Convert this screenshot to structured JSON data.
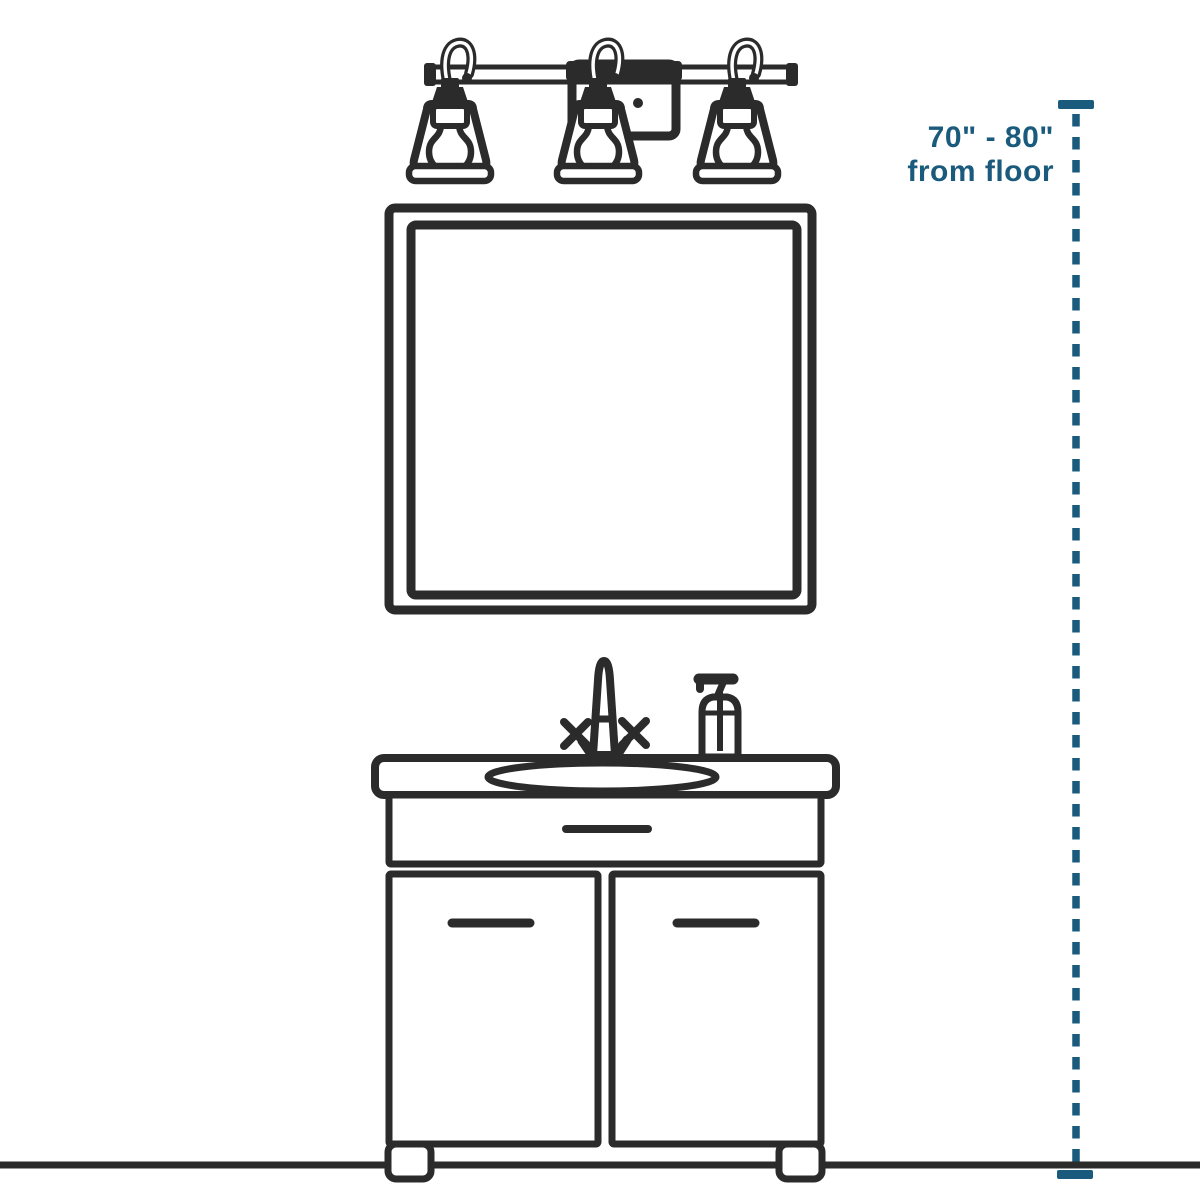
{
  "page": {
    "kind": "installation-height-diagram",
    "background": "#ffffff"
  },
  "annotation": {
    "line1": "70\" - 80\"",
    "line2": "from floor"
  },
  "colors": {
    "ink": "#2b2b2b",
    "accent": "#1a5b7d",
    "paper": "#ffffff"
  },
  "figure": {
    "style": "black-outline line drawing on white",
    "light_count": 3,
    "parts": [
      "three-light-vanity-bar-light",
      "square-wall-mirror",
      "bathroom-vanity-cabinet",
      "oval-sink-basin",
      "two-handle-faucet",
      "soap-dispenser",
      "drawer-front",
      "two-cabinet-doors",
      "cabinet-feet",
      "floor-line",
      "dashed-height-measurement-line"
    ],
    "measurement": {
      "from": "floor",
      "min": "70\"",
      "max": "80\""
    }
  }
}
